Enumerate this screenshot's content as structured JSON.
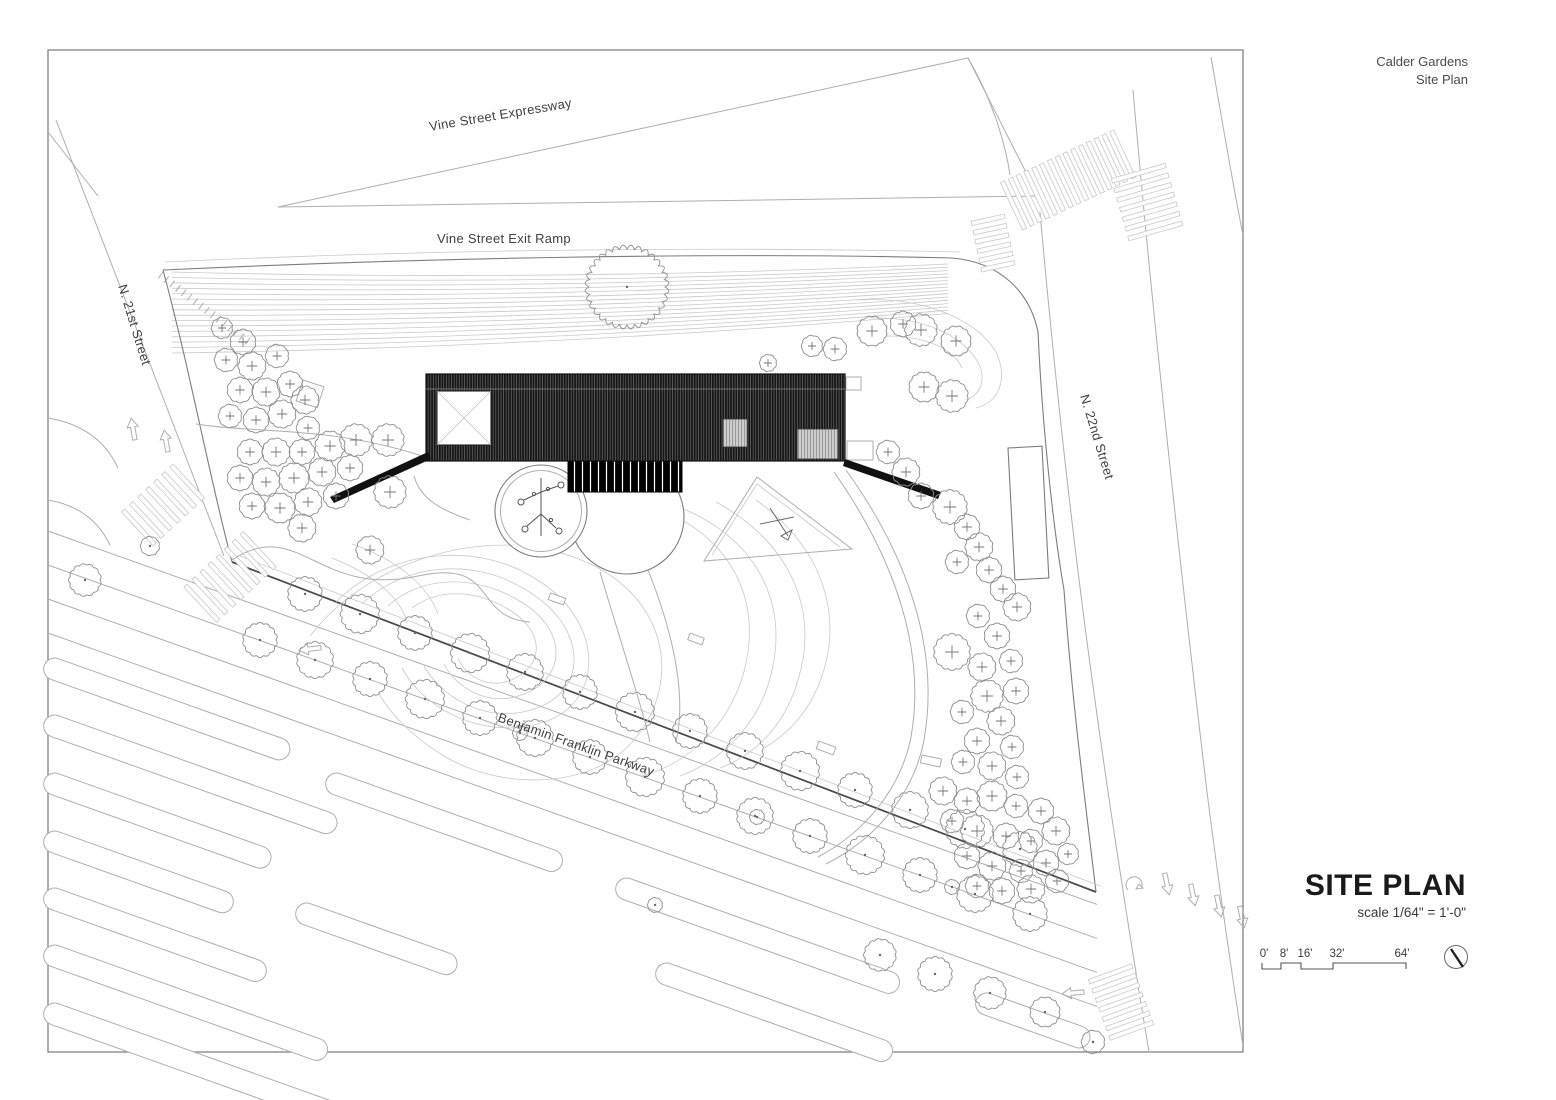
{
  "header": {
    "project": "Calder Gardens",
    "sheet": "Site Plan"
  },
  "labels": {
    "vine_expressway": {
      "text": "Vine Street Expressway"
    },
    "vine_exit_ramp": {
      "text": "Vine Street Exit Ramp"
    },
    "n21": {
      "text": "N. 21st Street"
    },
    "n22": {
      "text": "N. 22nd Street"
    },
    "parkway": {
      "text": "Benjamin Franklin Parkway"
    }
  },
  "titleblock": {
    "title": "SITE PLAN",
    "scale_note": "scale 1/64\" = 1'-0\"",
    "scalebar_labels": [
      "0'",
      "8'",
      "16'",
      "32'",
      "64'"
    ],
    "north_icon": "north-arrow-icon"
  },
  "colors": {
    "paper": "#ffffff",
    "frame": "#8c8c8c",
    "line_light": "#c9c9c9",
    "line_mid": "#aeaeae",
    "line_dark": "#7d7d7d",
    "building_fill": "#161616",
    "text": "#3a3a3a"
  },
  "plan": {
    "fan": {
      "n": 16,
      "x0": 172,
      "x1": 948,
      "yl0": 272,
      "dyl": 5.4,
      "yr0": 264,
      "dyr": 3.3,
      "sag": 14
    },
    "ticks": {
      "x0": 163,
      "y0": 272,
      "x1": 250,
      "y1": 338,
      "n": 15,
      "len": 8
    },
    "lanes": {
      "x0": 48,
      "y0": 497,
      "x1": 1097,
      "slope": 0.356,
      "offsets": [
        34,
        68,
        102,
        136
      ]
    },
    "strips": [
      [
        48,
        655,
        260
      ],
      [
        48,
        712,
        310
      ],
      [
        48,
        770,
        240
      ],
      [
        48,
        828,
        200
      ],
      [
        48,
        885,
        235
      ],
      [
        48,
        942,
        300
      ],
      [
        48,
        1000,
        330
      ],
      [
        330,
        770,
        250
      ],
      [
        300,
        900,
        170
      ],
      [
        620,
        875,
        300
      ],
      [
        660,
        960,
        250
      ],
      [
        980,
        990,
        120
      ]
    ],
    "crosswalks": [
      {
        "x": 1068,
        "y": 180,
        "rot": -25,
        "n": 15,
        "len": 52,
        "gap": 8.6
      },
      {
        "x": 993,
        "y": 243,
        "rot": 78,
        "n": 6,
        "len": 34,
        "gap": 9.5
      },
      {
        "x": 1147,
        "y": 202,
        "rot": 74,
        "n": 7,
        "len": 56,
        "gap": 10
      },
      {
        "x": 163,
        "y": 505,
        "rot": -43,
        "n": 7,
        "len": 46,
        "gap": 11
      },
      {
        "x": 230,
        "y": 577,
        "rot": -43,
        "n": 8,
        "len": 48,
        "gap": 11
      },
      {
        "x": 1121,
        "y": 1002,
        "rot": 70,
        "n": 7,
        "len": 46,
        "gap": 10
      }
    ],
    "arrows": [
      {
        "x": 133,
        "y": 429,
        "rot": -10
      },
      {
        "x": 166,
        "y": 441,
        "rot": -10
      },
      {
        "x": 1167,
        "y": 884,
        "rot": 168
      },
      {
        "x": 1193,
        "y": 895,
        "rot": 168
      },
      {
        "x": 1219,
        "y": 906,
        "rot": 168
      },
      {
        "x": 1242,
        "y": 917,
        "rot": 168
      },
      {
        "x": 1073,
        "y": 993,
        "rot": -95
      },
      {
        "x": 310,
        "y": 649,
        "rot": -97
      }
    ],
    "benches": [
      [
        557,
        599,
        16,
        7,
        20
      ],
      [
        696,
        639,
        15,
        7,
        20
      ],
      [
        826,
        748,
        18,
        8,
        20
      ],
      [
        931,
        761,
        20,
        8,
        12
      ]
    ],
    "trees_plus": [
      [
        222,
        328,
        10
      ],
      [
        243,
        342,
        12
      ],
      [
        226,
        360,
        11
      ],
      [
        252,
        366,
        13
      ],
      [
        277,
        356,
        11
      ],
      [
        240,
        390,
        12
      ],
      [
        266,
        392,
        13
      ],
      [
        290,
        384,
        12
      ],
      [
        230,
        416,
        11
      ],
      [
        256,
        420,
        12
      ],
      [
        282,
        414,
        13
      ],
      [
        305,
        400,
        13
      ],
      [
        308,
        428,
        11
      ],
      [
        250,
        452,
        12
      ],
      [
        276,
        452,
        13
      ],
      [
        302,
        452,
        12
      ],
      [
        330,
        446,
        14
      ],
      [
        356,
        440,
        15
      ],
      [
        388,
        440,
        15
      ],
      [
        240,
        478,
        12
      ],
      [
        266,
        482,
        13
      ],
      [
        294,
        478,
        14
      ],
      [
        322,
        472,
        13
      ],
      [
        350,
        468,
        12
      ],
      [
        252,
        506,
        12
      ],
      [
        280,
        508,
        14
      ],
      [
        308,
        502,
        13
      ],
      [
        336,
        496,
        12
      ],
      [
        302,
        528,
        13
      ],
      [
        390,
        492,
        15
      ],
      [
        370,
        550,
        13
      ],
      [
        812,
        346,
        10
      ],
      [
        835,
        349,
        11
      ],
      [
        872,
        331,
        14
      ],
      [
        903,
        324,
        12
      ],
      [
        921,
        330,
        15
      ],
      [
        956,
        341,
        14
      ],
      [
        924,
        387,
        14
      ],
      [
        952,
        396,
        15
      ],
      [
        768,
        363,
        8
      ],
      [
        888,
        452,
        11
      ],
      [
        906,
        472,
        13
      ],
      [
        921,
        496,
        12
      ],
      [
        950,
        507,
        16
      ],
      [
        967,
        527,
        12
      ],
      [
        979,
        547,
        13
      ],
      [
        957,
        562,
        11
      ],
      [
        989,
        570,
        12
      ],
      [
        1003,
        589,
        12
      ],
      [
        1017,
        607,
        13
      ],
      [
        978,
        616,
        11
      ],
      [
        997,
        636,
        12
      ],
      [
        952,
        652,
        17
      ],
      [
        982,
        667,
        13
      ],
      [
        1011,
        661,
        11
      ],
      [
        1016,
        691,
        12
      ],
      [
        987,
        696,
        15
      ],
      [
        962,
        712,
        11
      ],
      [
        1001,
        721,
        13
      ],
      [
        977,
        741,
        12
      ],
      [
        1012,
        747,
        11
      ],
      [
        992,
        766,
        13
      ],
      [
        1017,
        777,
        11
      ],
      [
        963,
        762,
        11
      ],
      [
        943,
        791,
        13
      ],
      [
        967,
        801,
        12
      ],
      [
        992,
        796,
        14
      ],
      [
        1016,
        806,
        11
      ],
      [
        1041,
        811,
        12
      ],
      [
        952,
        821,
        11
      ],
      [
        977,
        831,
        15
      ],
      [
        1006,
        836,
        12
      ],
      [
        1031,
        841,
        11
      ],
      [
        1056,
        831,
        13
      ],
      [
        967,
        856,
        12
      ],
      [
        992,
        866,
        13
      ],
      [
        1021,
        871,
        11
      ],
      [
        1046,
        863,
        12
      ],
      [
        977,
        886,
        11
      ],
      [
        1002,
        891,
        12
      ],
      [
        1031,
        889,
        13
      ],
      [
        1057,
        881,
        11
      ],
      [
        1068,
        854,
        10
      ]
    ],
    "trees_dot": [
      [
        305,
        594,
        16
      ],
      [
        360,
        614,
        18
      ],
      [
        415,
        633,
        16
      ],
      [
        470,
        653,
        18
      ],
      [
        525,
        672,
        17
      ],
      [
        580,
        692,
        16
      ],
      [
        635,
        712,
        18
      ],
      [
        690,
        731,
        16
      ],
      [
        745,
        751,
        17
      ],
      [
        800,
        771,
        18
      ],
      [
        855,
        790,
        16
      ],
      [
        910,
        810,
        17
      ],
      [
        965,
        829,
        18
      ],
      [
        1020,
        849,
        16
      ],
      [
        260,
        640,
        16
      ],
      [
        315,
        660,
        17
      ],
      [
        370,
        679,
        16
      ],
      [
        425,
        699,
        18
      ],
      [
        480,
        718,
        16
      ],
      [
        535,
        738,
        17
      ],
      [
        590,
        757,
        16
      ],
      [
        645,
        777,
        18
      ],
      [
        700,
        796,
        16
      ],
      [
        755,
        816,
        17
      ],
      [
        810,
        836,
        16
      ],
      [
        865,
        855,
        18
      ],
      [
        920,
        875,
        16
      ],
      [
        975,
        894,
        17
      ],
      [
        1030,
        914,
        16
      ],
      [
        880,
        955,
        15
      ],
      [
        935,
        974,
        16
      ],
      [
        990,
        993,
        15
      ],
      [
        1045,
        1012,
        14
      ],
      [
        1093,
        1042,
        11
      ],
      [
        520,
        733,
        7
      ],
      [
        757,
        817,
        7
      ],
      [
        952,
        887,
        7
      ],
      [
        655,
        905,
        7
      ],
      [
        85,
        580,
        15
      ],
      [
        150,
        546,
        9
      ],
      [
        627,
        287,
        38
      ]
    ]
  }
}
